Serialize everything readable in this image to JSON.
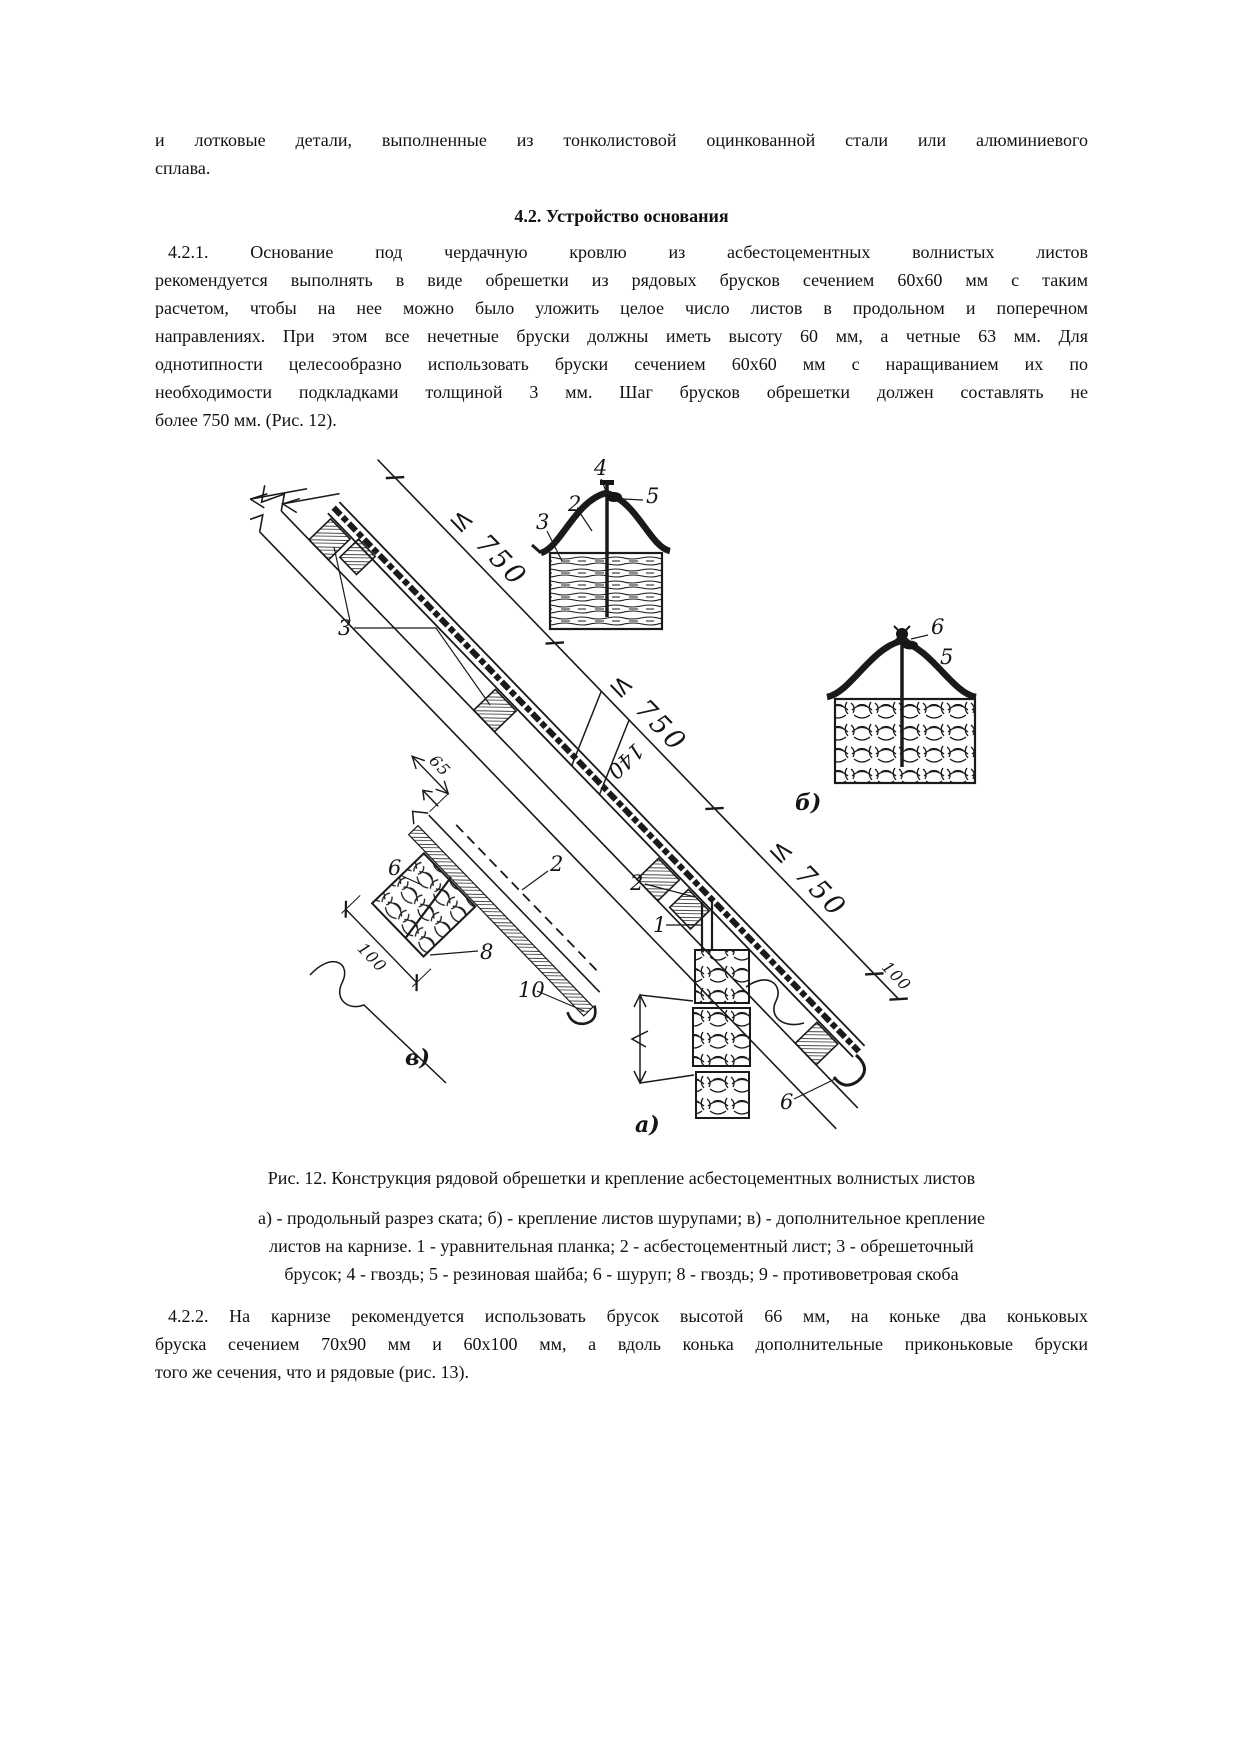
{
  "page": {
    "background": "#ffffff",
    "text_color": "#111111"
  },
  "content": {
    "intro_lines": [
      "и лотковые детали, выполненные из тонколистовой оцинкованной стали или алюминиевого",
      "сплава."
    ],
    "section_heading": "4.2. Устройство основания",
    "p421_lines": [
      "4.2.1. Основание под чердачную кровлю из асбестоцементных волнистых листов",
      "рекомендуется выполнять в виде обрешетки из рядовых брусков сечением 60х60 мм с таким",
      "расчетом, чтобы на нее можно было уложить целое число листов в продольном и поперечном",
      "направлениях. При этом все нечетные бруски должны иметь высоту 60 мм, а четные 63 мм. Для",
      "однотипности целесообразно использовать бруски сечением 60х60 мм с наращиванием их по",
      "необходимости подкладками толщиной 3 мм. Шаг брусков обрешетки должен составлять не",
      "более 750 мм. (Рис. 12)."
    ],
    "p422_lines": [
      "4.2.2. На карнизе рекомендуется использовать брусок высотой 66 мм, на коньке два коньковых",
      "бруска сечением 70х90 мм и 60х100 мм, а вдоль конька дополнительные приконьковые бруски",
      "того же сечения, что и рядовые (рис. 13)."
    ]
  },
  "figure": {
    "caption": "Рис. 12. Конструкция рядовой обрешетки и крепление асбестоцементных волнистых листов",
    "legend_lines": [
      "а) - продольный разрез ската; б) - крепление листов шурупами; в) - дополнительное крепление",
      "листов на карнизе. 1 - уравнительная планка; 2 - асбестоцементный лист; 3 - обрешеточный",
      "брусок; 4 - гвоздь; 5 - резиновая шайба; 6 - шуруп; 8 - гвоздь; 9 - противоветровая скоба"
    ],
    "dims": {
      "d750": "≤ 750",
      "d140": "140",
      "d100": "100",
      "d65": "65"
    },
    "labels": {
      "n1": "1",
      "n2": "2",
      "n3": "3",
      "n4": "4",
      "n5": "5",
      "n6": "6",
      "n8": "8",
      "n10": "10",
      "va": "а)",
      "vb": "б)",
      "vv": "в)"
    }
  }
}
